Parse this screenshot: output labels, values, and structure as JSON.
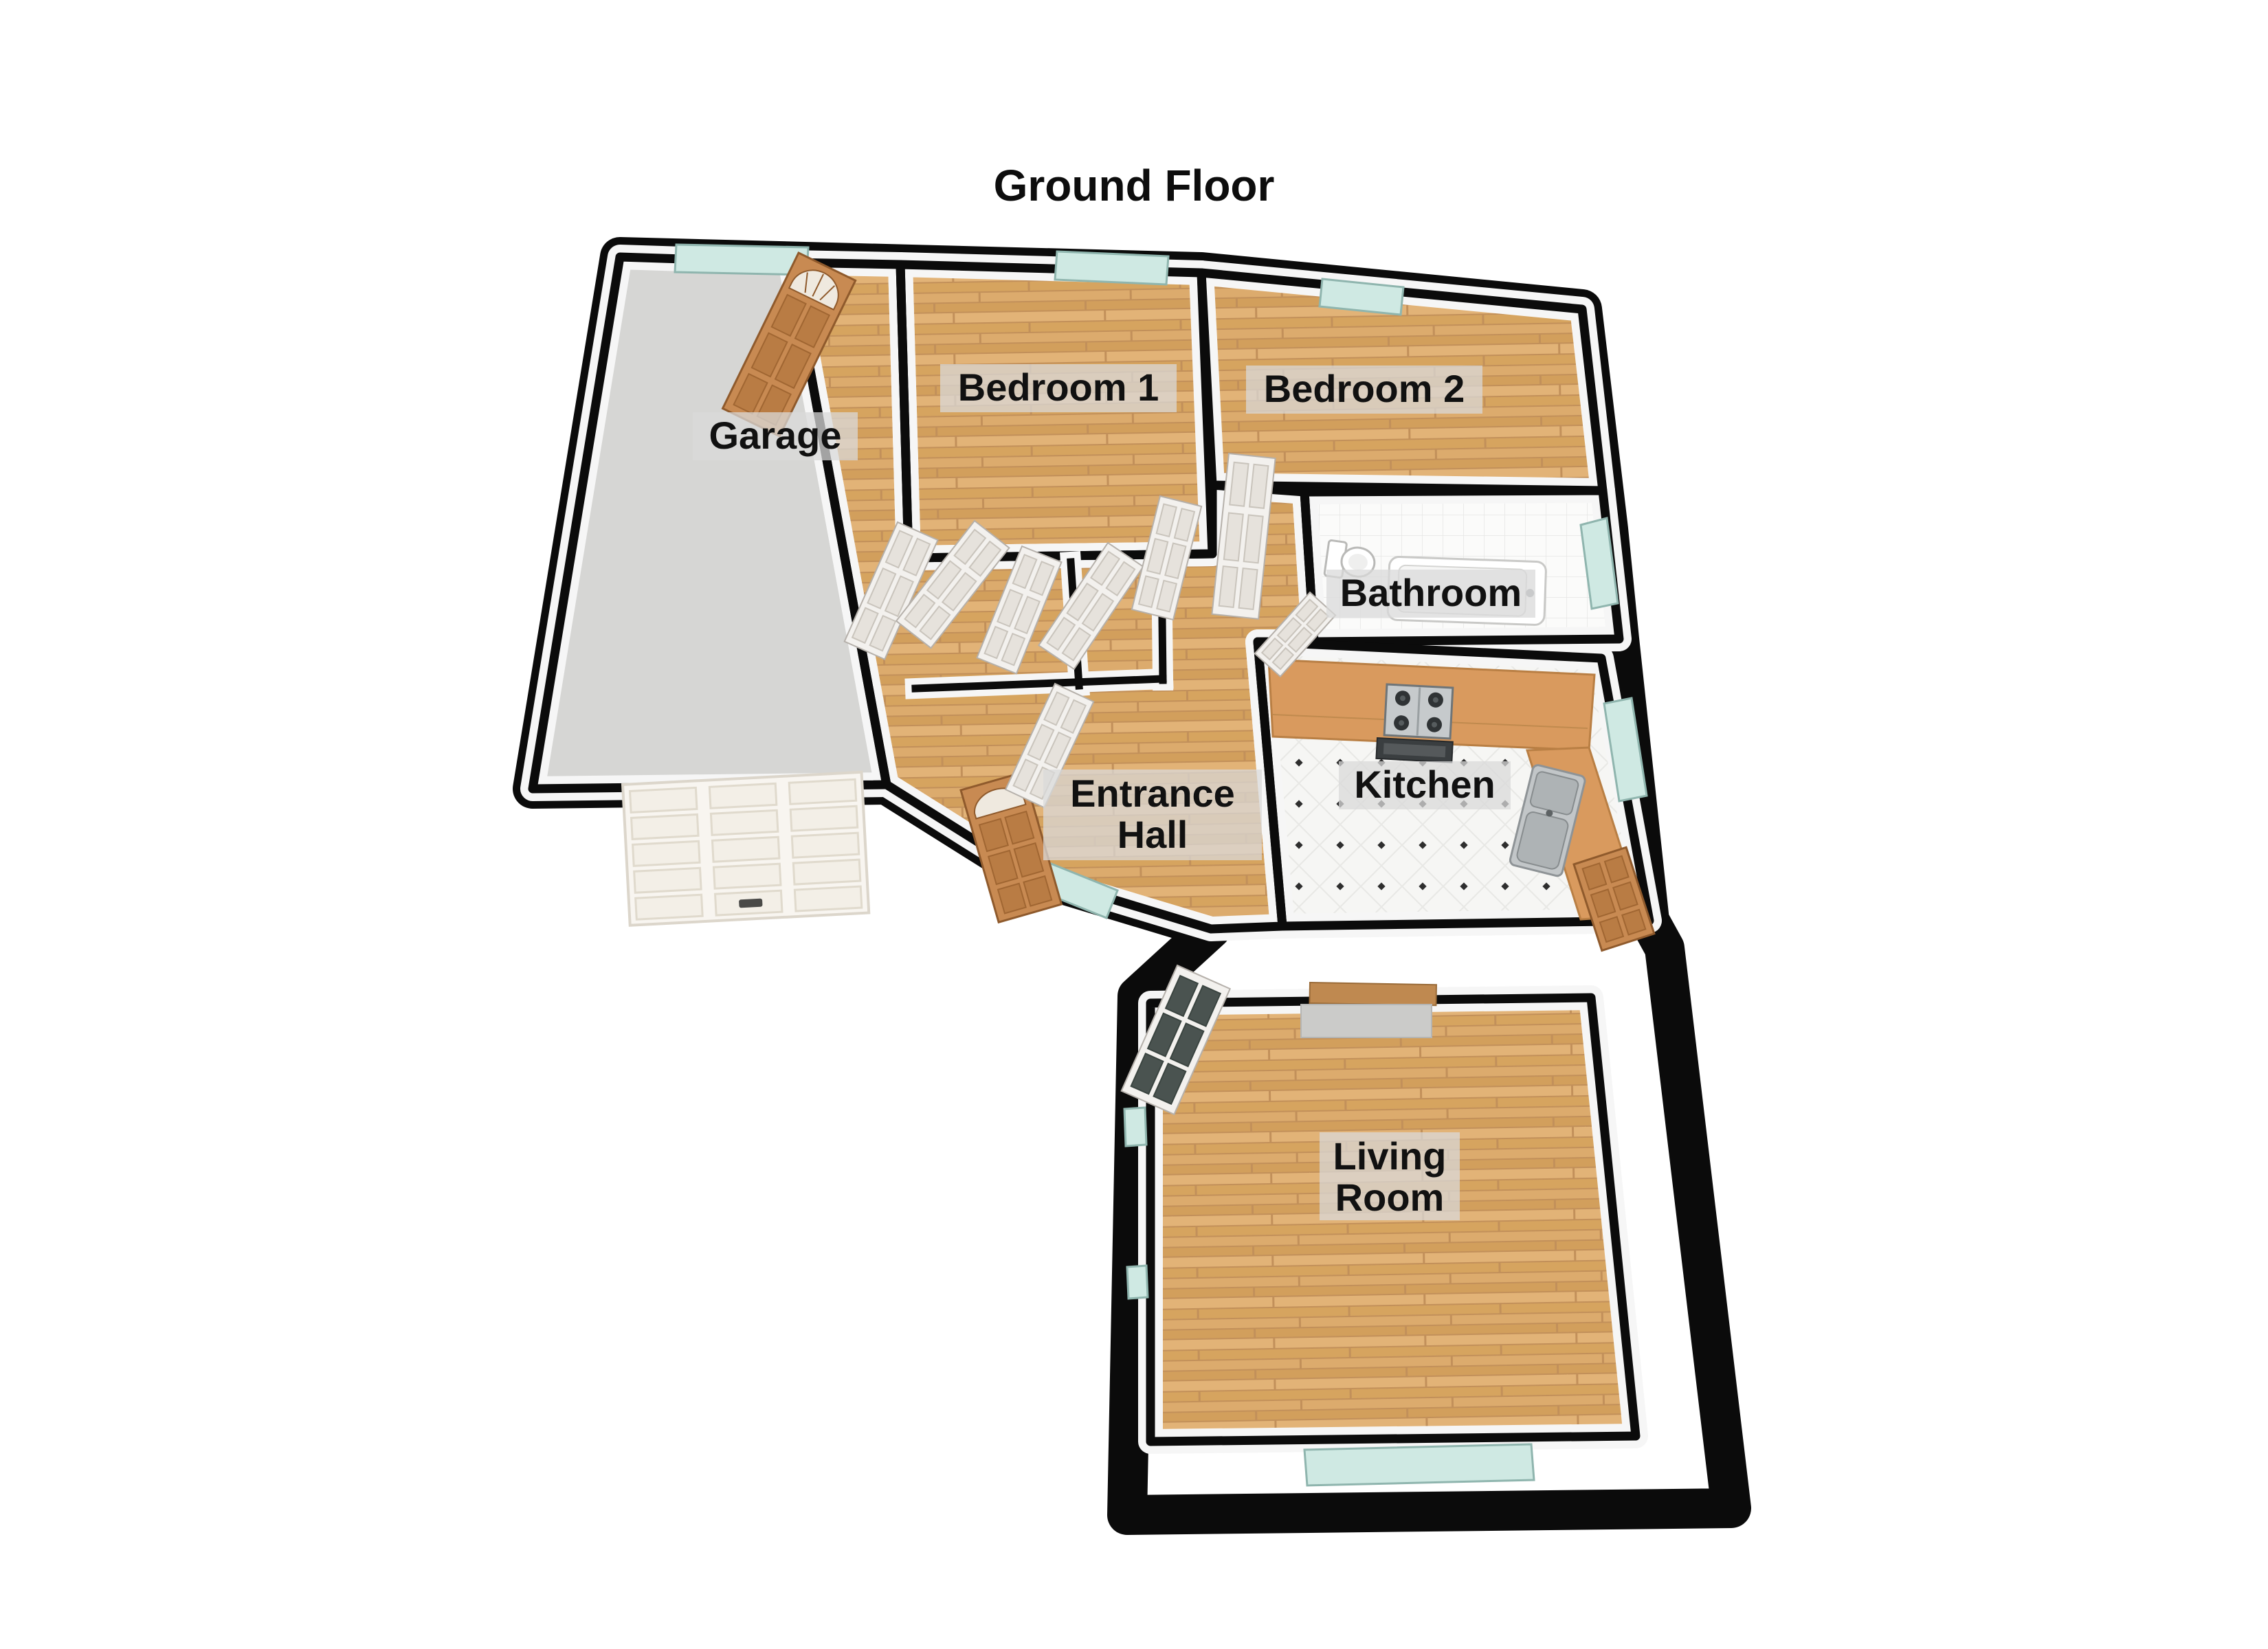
{
  "title": "Ground Floor",
  "floor_plan": {
    "labels": {
      "garage": "Garage",
      "bedroom1": "Bedroom 1",
      "bedroom2": "Bedroom 2",
      "bathroom": "Bathroom",
      "entrance_hall_line1": "Entrance",
      "entrance_hall_line2": "Hall",
      "kitchen": "Kitchen",
      "living_room_line1": "Living",
      "living_room_line2": "Room"
    },
    "rooms": [
      {
        "name": "Garage",
        "floor": "grey-concrete"
      },
      {
        "name": "Bedroom 1",
        "floor": "wood"
      },
      {
        "name": "Bedroom 2",
        "floor": "wood"
      },
      {
        "name": "Bathroom",
        "floor": "white-tile"
      },
      {
        "name": "Entrance Hall",
        "floor": "wood"
      },
      {
        "name": "Kitchen",
        "floor": "white-diamond-tile"
      },
      {
        "name": "Living Room",
        "floor": "wood"
      }
    ],
    "palette": {
      "wall": "#0b0b0b",
      "wall_face": "#f6f6f6",
      "wood_floor": "#d9a764",
      "garage_floor": "#d6d6d4",
      "window_glass": "#cfe9e3",
      "external_door": "#c88a52",
      "internal_door": "#f3f1ee",
      "kitchen_counter": "#d99a5e",
      "label_background": "#d9d9d9",
      "label_text": "#111111"
    }
  }
}
